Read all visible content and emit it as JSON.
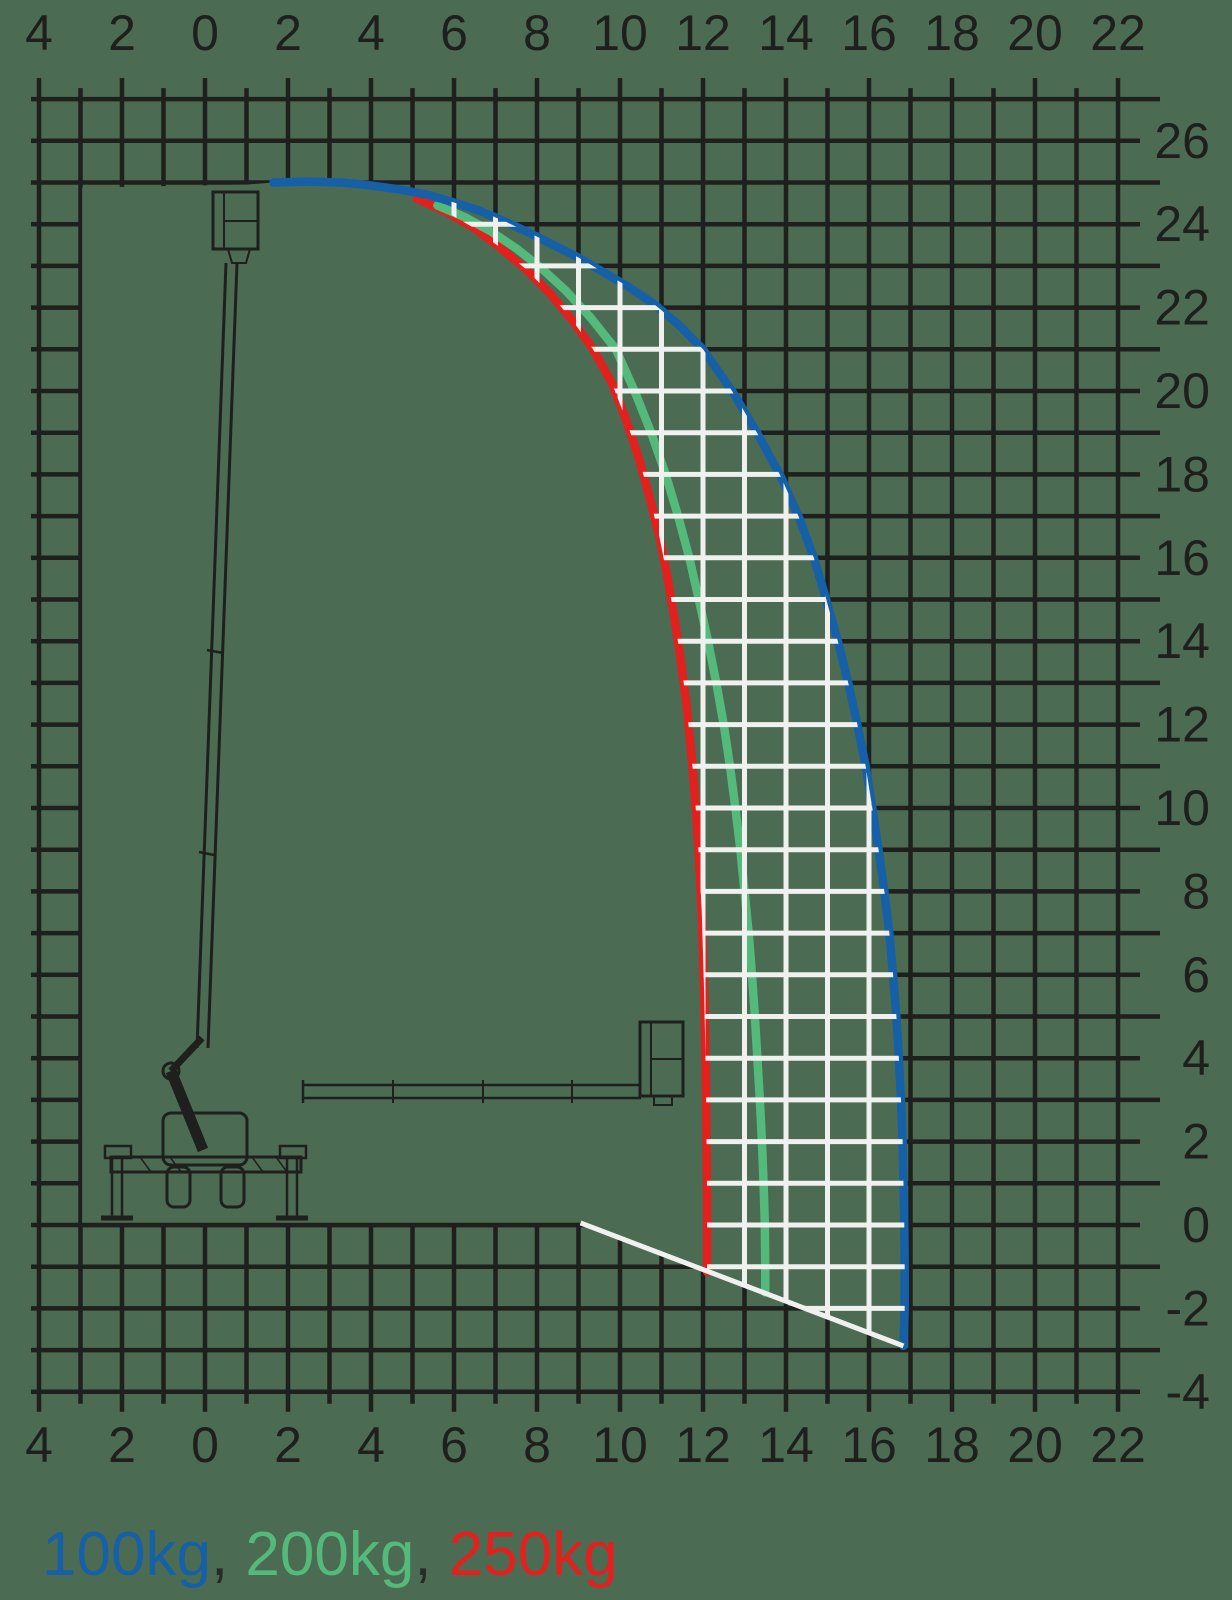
{
  "background_color": "#4b6c52",
  "colors": {
    "grid_black": "#1f1f1d",
    "grid_white": "#f0f0ee",
    "text": "#1f1f1d",
    "separator_text": "#2a2a28",
    "blue_100kg": "#1660a8",
    "green_200kg": "#53ba7b",
    "red_250kg": "#e2201e"
  },
  "legend": {
    "separator": ", ",
    "items": [
      {
        "label": "100kg",
        "color": "#1660a8"
      },
      {
        "label": "200kg",
        "color": "#53ba7b"
      },
      {
        "label": "250kg",
        "color": "#e2201e"
      }
    ]
  },
  "chart_data": {
    "type": "line",
    "title": "",
    "xlabel": "",
    "ylabel": "",
    "grid": true,
    "legend_position": "bottom-left",
    "scale": {
      "x0_px": 205,
      "px_per_unit_x": 41.5,
      "y0_px": 1225,
      "px_per_unit_y": 41.7,
      "plot": {
        "x_min": -4,
        "x_max": 22,
        "y_min": -4,
        "y_max": 27
      }
    },
    "x_axis": {
      "min": -4,
      "max": 22,
      "minor_step": 1,
      "label_step": 2,
      "tick_values": [
        -4,
        -2,
        0,
        2,
        4,
        6,
        8,
        10,
        12,
        14,
        16,
        18,
        20,
        22
      ],
      "tick_labels": [
        "4",
        "2",
        "0",
        "2",
        "4",
        "6",
        "8",
        "10",
        "12",
        "14",
        "16",
        "18",
        "20",
        "22"
      ]
    },
    "y_axis": {
      "min": -4,
      "max": 27,
      "minor_step": 1,
      "label_step": 2,
      "tick_values": [
        26,
        24,
        22,
        20,
        18,
        16,
        14,
        12,
        10,
        8,
        6,
        4,
        2,
        0,
        -2,
        -4
      ],
      "tick_labels": [
        "26",
        "24",
        "22",
        "20",
        "18",
        "16",
        "14",
        "12",
        "10",
        "8",
        "6",
        "4",
        "2",
        "0",
        "-2",
        "-4"
      ]
    },
    "series": [
      {
        "name": "100kg",
        "color": "#1660a8",
        "points": [
          [
            1.65,
            25.0
          ],
          [
            2.5,
            25.02
          ],
          [
            3.3,
            25.0
          ],
          [
            4.0,
            24.93
          ],
          [
            4.7,
            24.83
          ],
          [
            5.4,
            24.7
          ],
          [
            6.0,
            24.52
          ],
          [
            6.6,
            24.33
          ],
          [
            7.2,
            24.08
          ],
          [
            7.8,
            23.8
          ],
          [
            8.4,
            23.5
          ],
          [
            9.0,
            23.2
          ],
          [
            9.6,
            22.85
          ],
          [
            10.2,
            22.5
          ],
          [
            10.8,
            22.1
          ],
          [
            11.4,
            21.6
          ],
          [
            12.0,
            21.0
          ],
          [
            12.7,
            20.0
          ],
          [
            13.3,
            19.0
          ],
          [
            13.85,
            18.0
          ],
          [
            14.3,
            17.0
          ],
          [
            14.67,
            16.0
          ],
          [
            14.97,
            15.0
          ],
          [
            15.25,
            14.0
          ],
          [
            15.5,
            13.0
          ],
          [
            15.72,
            12.0
          ],
          [
            15.92,
            11.0
          ],
          [
            16.08,
            10.0
          ],
          [
            16.23,
            9.0
          ],
          [
            16.37,
            8.0
          ],
          [
            16.49,
            7.0
          ],
          [
            16.58,
            6.0
          ],
          [
            16.66,
            5.0
          ],
          [
            16.72,
            4.0
          ],
          [
            16.77,
            3.0
          ],
          [
            16.81,
            2.0
          ],
          [
            16.83,
            1.0
          ],
          [
            16.85,
            0.0
          ],
          [
            16.86,
            -1.0
          ],
          [
            16.86,
            -2.0
          ],
          [
            16.83,
            -2.9
          ]
        ]
      },
      {
        "name": "200kg",
        "color": "#53ba7b",
        "points": [
          [
            5.6,
            24.45
          ],
          [
            6.3,
            24.15
          ],
          [
            6.9,
            23.82
          ],
          [
            7.5,
            23.42
          ],
          [
            8.1,
            22.95
          ],
          [
            8.7,
            22.4
          ],
          [
            9.3,
            21.75
          ],
          [
            9.9,
            21.0
          ],
          [
            10.35,
            20.0
          ],
          [
            10.75,
            19.0
          ],
          [
            11.1,
            18.0
          ],
          [
            11.4,
            17.0
          ],
          [
            11.67,
            16.0
          ],
          [
            11.9,
            15.0
          ],
          [
            12.12,
            14.0
          ],
          [
            12.32,
            13.0
          ],
          [
            12.5,
            12.0
          ],
          [
            12.65,
            11.0
          ],
          [
            12.78,
            10.0
          ],
          [
            12.9,
            9.0
          ],
          [
            13.0,
            8.0
          ],
          [
            13.1,
            7.0
          ],
          [
            13.18,
            6.0
          ],
          [
            13.25,
            5.0
          ],
          [
            13.31,
            4.0
          ],
          [
            13.37,
            3.0
          ],
          [
            13.42,
            2.0
          ],
          [
            13.46,
            1.0
          ],
          [
            13.49,
            0.0
          ],
          [
            13.5,
            -1.0
          ],
          [
            13.5,
            -1.62
          ]
        ]
      },
      {
        "name": "250kg",
        "color": "#e2201e",
        "points": [
          [
            5.1,
            24.62
          ],
          [
            5.8,
            24.3
          ],
          [
            6.5,
            23.9
          ],
          [
            7.1,
            23.45
          ],
          [
            7.7,
            22.95
          ],
          [
            8.3,
            22.35
          ],
          [
            8.85,
            21.7
          ],
          [
            9.35,
            21.0
          ],
          [
            9.8,
            20.2
          ],
          [
            10.15,
            19.3
          ],
          [
            10.45,
            18.4
          ],
          [
            10.7,
            17.5
          ],
          [
            10.95,
            16.5
          ],
          [
            11.15,
            15.5
          ],
          [
            11.32,
            14.5
          ],
          [
            11.47,
            13.5
          ],
          [
            11.6,
            12.5
          ],
          [
            11.7,
            11.5
          ],
          [
            11.79,
            10.5
          ],
          [
            11.86,
            9.5
          ],
          [
            11.92,
            8.5
          ],
          [
            11.97,
            7.5
          ],
          [
            12.0,
            6.5
          ],
          [
            12.03,
            5.5
          ],
          [
            12.05,
            4.5
          ],
          [
            12.07,
            3.5
          ],
          [
            12.08,
            2.5
          ],
          [
            12.09,
            1.5
          ],
          [
            12.1,
            0.5
          ],
          [
            12.1,
            -1.13
          ]
        ]
      }
    ],
    "below_grade_boundary": {
      "from": [
        9.05,
        0.05
      ],
      "to": [
        16.83,
        -2.9
      ],
      "color": "#f0f0ee"
    },
    "ground_line": {
      "from_x": -2.96,
      "to_x": 9.1,
      "y": 0
    },
    "envelope_fill": "white-gridlines-between-250kg-and-100kg-curves"
  },
  "machine_drawing": {
    "stroke_color": "#1f1f1d",
    "parts": [
      {
        "name": "upper-basket",
        "type": "rect",
        "x": 213,
        "y": 192,
        "w": 45,
        "h": 57,
        "sw": 3
      },
      {
        "name": "upper-basket-divider",
        "type": "line",
        "x1": 224,
        "y1": 192,
        "x2": 224,
        "y2": 249,
        "sw": 2
      },
      {
        "name": "upper-basket-rail",
        "type": "line",
        "x1": 224,
        "y1": 221,
        "x2": 258,
        "y2": 221,
        "sw": 2
      },
      {
        "name": "upper-basket-mount",
        "type": "poly",
        "pts": [
          [
            228,
            249
          ],
          [
            250,
            249
          ],
          [
            246,
            263
          ],
          [
            232,
            263
          ]
        ],
        "sw": 2
      },
      {
        "name": "mast-left-edge",
        "type": "line",
        "x1": 226,
        "y1": 263,
        "x2": 197,
        "y2": 1048,
        "sw": 3
      },
      {
        "name": "mast-right-edge",
        "type": "line",
        "x1": 237,
        "y1": 263,
        "x2": 208,
        "y2": 1048,
        "sw": 3
      },
      {
        "name": "mast-joint-1",
        "type": "line",
        "x1": 207,
        "y1": 650,
        "x2": 223,
        "y2": 653,
        "sw": 2.5
      },
      {
        "name": "mast-joint-2",
        "type": "line",
        "x1": 199,
        "y1": 852,
        "x2": 214,
        "y2": 855,
        "sw": 2.5
      },
      {
        "name": "elbow-upper-arm",
        "type": "line",
        "x1": 202,
        "y1": 1038,
        "x2": 171,
        "y2": 1071,
        "sw": 7
      },
      {
        "name": "elbow-pivot",
        "type": "circle",
        "cx": 171,
        "cy": 1071,
        "r": 8,
        "sw": 3
      },
      {
        "name": "elbow-lower-arm",
        "type": "line",
        "x1": 171,
        "y1": 1071,
        "x2": 203,
        "y2": 1150,
        "sw": 11
      },
      {
        "name": "chassis",
        "type": "rect",
        "x": 163,
        "y": 1113,
        "w": 84,
        "h": 52,
        "rx": 8,
        "sw": 3
      },
      {
        "name": "wheel-left",
        "type": "rect",
        "x": 167,
        "y": 1167,
        "w": 23,
        "h": 40,
        "rx": 7,
        "sw": 3
      },
      {
        "name": "wheel-right",
        "type": "rect",
        "x": 221,
        "y": 1167,
        "w": 23,
        "h": 40,
        "rx": 7,
        "sw": 3
      },
      {
        "name": "outrigger-beam",
        "type": "rect",
        "x": 111,
        "y": 1157,
        "w": 190,
        "h": 15,
        "sw": 3
      },
      {
        "name": "beam-hatch-1",
        "type": "line",
        "x1": 140,
        "y1": 1157,
        "x2": 151,
        "y2": 1172,
        "sw": 1.5
      },
      {
        "name": "beam-hatch-2",
        "type": "line",
        "x1": 170,
        "y1": 1157,
        "x2": 181,
        "y2": 1172,
        "sw": 1.5
      },
      {
        "name": "beam-hatch-3",
        "type": "line",
        "x1": 252,
        "y1": 1157,
        "x2": 263,
        "y2": 1172,
        "sw": 1.5
      },
      {
        "name": "beam-hatch-4",
        "type": "line",
        "x1": 276,
        "y1": 1157,
        "x2": 287,
        "y2": 1172,
        "sw": 1.5
      },
      {
        "name": "outrigger-cap-left",
        "type": "rect",
        "x": 105,
        "y": 1146,
        "w": 26,
        "h": 12,
        "sw": 2.5
      },
      {
        "name": "outrigger-leg-left-a",
        "type": "line",
        "x1": 112,
        "y1": 1158,
        "x2": 112,
        "y2": 1216,
        "sw": 2.5
      },
      {
        "name": "outrigger-leg-left-b",
        "type": "line",
        "x1": 122,
        "y1": 1158,
        "x2": 122,
        "y2": 1216,
        "sw": 2.5
      },
      {
        "name": "outrigger-foot-left",
        "type": "line",
        "x1": 101,
        "y1": 1218,
        "x2": 133,
        "y2": 1218,
        "sw": 5
      },
      {
        "name": "outrigger-cap-right",
        "type": "rect",
        "x": 280,
        "y": 1146,
        "w": 26,
        "h": 12,
        "sw": 2.5
      },
      {
        "name": "outrigger-leg-right-a",
        "type": "line",
        "x1": 287,
        "y1": 1158,
        "x2": 287,
        "y2": 1216,
        "sw": 2.5
      },
      {
        "name": "outrigger-leg-right-b",
        "type": "line",
        "x1": 297,
        "y1": 1158,
        "x2": 297,
        "y2": 1216,
        "sw": 2.5
      },
      {
        "name": "outrigger-foot-right",
        "type": "line",
        "x1": 276,
        "y1": 1218,
        "x2": 308,
        "y2": 1218,
        "sw": 5
      },
      {
        "name": "telescopic-boom-top",
        "type": "line",
        "x1": 303,
        "y1": 1085,
        "x2": 641,
        "y2": 1085,
        "sw": 2.5
      },
      {
        "name": "telescopic-boom-bottom",
        "type": "line",
        "x1": 303,
        "y1": 1098,
        "x2": 641,
        "y2": 1098,
        "sw": 2.5
      },
      {
        "name": "telescopic-boom-left-cap",
        "type": "line",
        "x1": 303,
        "y1": 1080,
        "x2": 303,
        "y2": 1103,
        "sw": 2.5
      },
      {
        "name": "boom-section-mark-1",
        "type": "line",
        "x1": 393,
        "y1": 1080,
        "x2": 393,
        "y2": 1103,
        "sw": 2
      },
      {
        "name": "boom-section-mark-2",
        "type": "line",
        "x1": 483,
        "y1": 1080,
        "x2": 483,
        "y2": 1103,
        "sw": 2
      },
      {
        "name": "boom-section-mark-3",
        "type": "line",
        "x1": 572,
        "y1": 1080,
        "x2": 572,
        "y2": 1103,
        "sw": 2
      },
      {
        "name": "lower-basket",
        "type": "rect",
        "x": 640,
        "y": 1022,
        "w": 43,
        "h": 74,
        "sw": 3
      },
      {
        "name": "lower-basket-divider",
        "type": "line",
        "x1": 651,
        "y1": 1022,
        "x2": 651,
        "y2": 1096,
        "sw": 2
      },
      {
        "name": "lower-basket-rail",
        "type": "line",
        "x1": 651,
        "y1": 1059,
        "x2": 683,
        "y2": 1059,
        "sw": 2
      },
      {
        "name": "lower-basket-mount",
        "type": "rect",
        "x": 654,
        "y": 1096,
        "w": 18,
        "h": 9,
        "sw": 2
      }
    ]
  }
}
